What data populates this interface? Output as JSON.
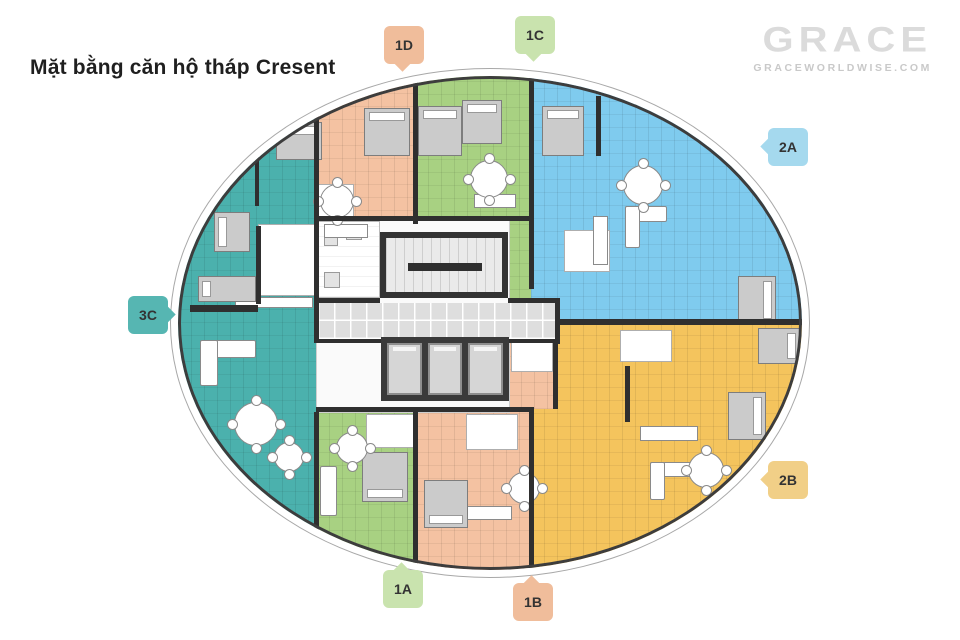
{
  "title": "Mặt bằng căn hộ tháp Cresent",
  "brand": {
    "logo_text": "GRACE",
    "website": "GRACEWORLDWISE.COM",
    "logo_color": "#dbdbdb"
  },
  "units": [
    {
      "id": "3C",
      "tag_color": "#56B6B2",
      "floor_color": "#4BB1AD"
    },
    {
      "id": "1D",
      "tag_color": "#F0BD9B",
      "floor_color": "#F4C2A2"
    },
    {
      "id": "1C",
      "tag_color": "#C9E3AE",
      "floor_color": "#A8D182"
    },
    {
      "id": "2A",
      "tag_color": "#A5D9EE",
      "floor_color": "#7FCBEE"
    },
    {
      "id": "2B",
      "tag_color": "#F1CF87",
      "floor_color": "#F4C45D"
    },
    {
      "id": "1A",
      "tag_color": "#C9E3AE",
      "floor_color": "#A8D182"
    },
    {
      "id": "1B",
      "tag_color": "#F0BD9B",
      "floor_color": "#F4C2A2"
    }
  ],
  "core": {
    "elevator_count": 3,
    "wall_color": "#2f2f2f"
  }
}
